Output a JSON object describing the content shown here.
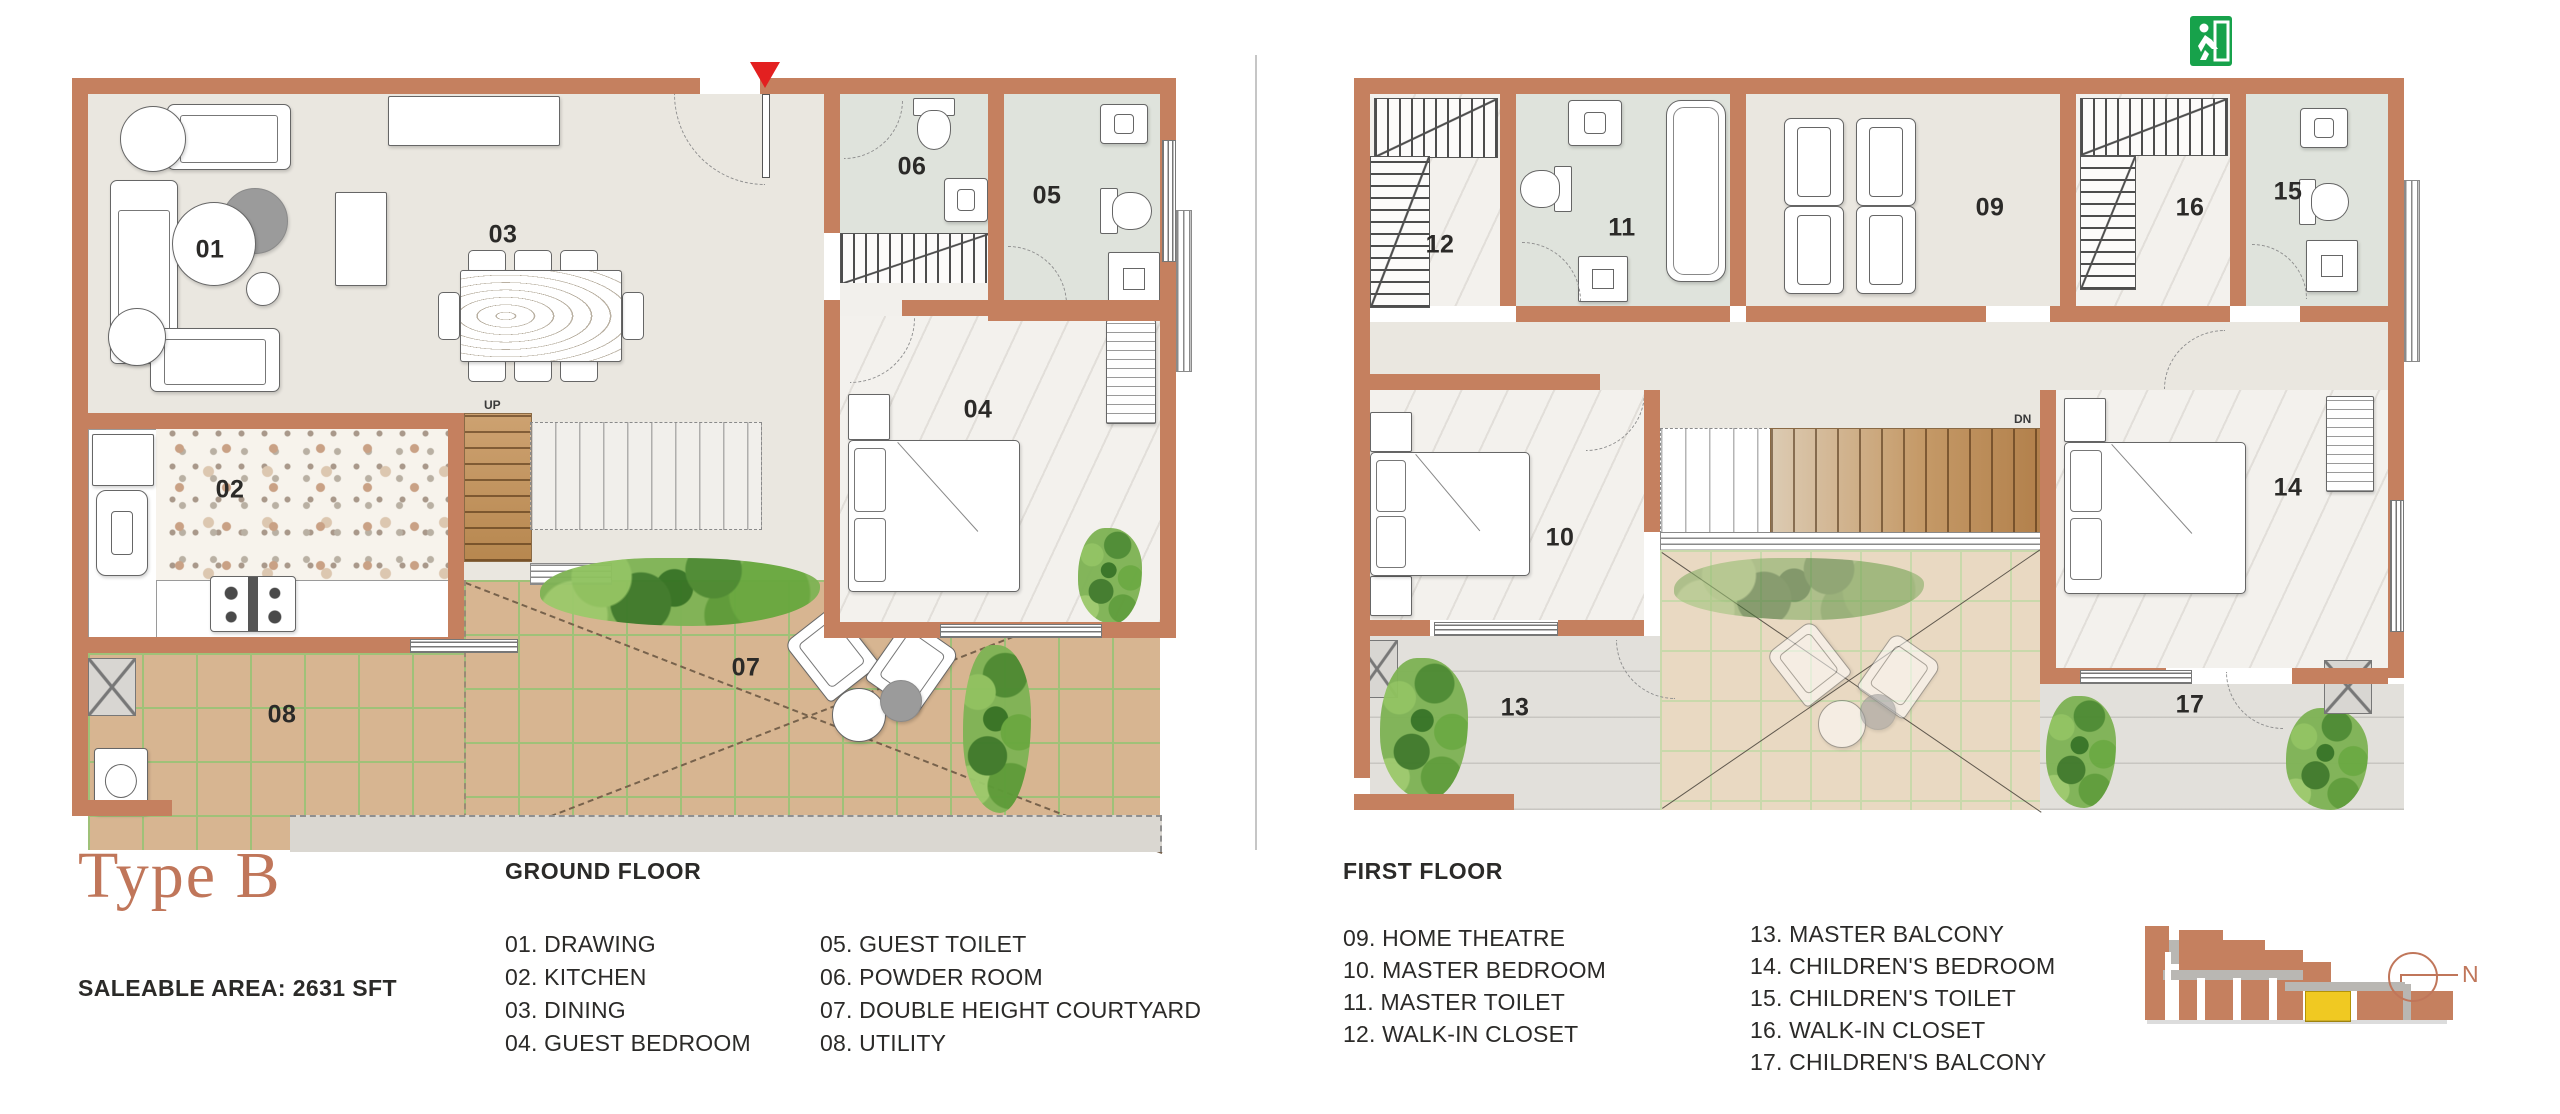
{
  "title": "Type B",
  "saleable_area": "SALEABLE AREA: 2631 SFT",
  "ground_floor": {
    "heading": "GROUND FLOOR",
    "legend_col1": [
      "01. DRAWING",
      "02. KITCHEN",
      "03. DINING",
      "04. GUEST BEDROOM"
    ],
    "legend_col2": [
      "05. GUEST TOILET",
      "06. POWDER ROOM",
      "07. DOUBLE HEIGHT COURTYARD",
      "08. UTILITY"
    ],
    "room_labels": [
      {
        "num": "01",
        "x": 150,
        "y": 190
      },
      {
        "num": "02",
        "x": 170,
        "y": 430
      },
      {
        "num": "03",
        "x": 443,
        "y": 175
      },
      {
        "num": "04",
        "x": 918,
        "y": 350
      },
      {
        "num": "05",
        "x": 987,
        "y": 136
      },
      {
        "num": "06",
        "x": 852,
        "y": 107
      },
      {
        "num": "07",
        "x": 686,
        "y": 608
      },
      {
        "num": "08",
        "x": 222,
        "y": 655
      }
    ],
    "stair_label_up": "UP"
  },
  "first_floor": {
    "heading": "FIRST FLOOR",
    "legend_col1": [
      "09. HOME THEATRE",
      "10. MASTER BEDROOM",
      "11. MASTER TOILET",
      "12. WALK-IN CLOSET"
    ],
    "legend_col2": [
      "13. MASTER BALCONY",
      "14. CHILDREN'S BEDROOM",
      "15. CHILDREN'S TOILET",
      "16. WALK-IN CLOSET",
      "17. CHILDREN'S BALCONY"
    ],
    "room_labels": [
      {
        "num": "09",
        "x": 650,
        "y": 148
      },
      {
        "num": "10",
        "x": 220,
        "y": 478
      },
      {
        "num": "11",
        "x": 282,
        "y": 168
      },
      {
        "num": "12",
        "x": 100,
        "y": 185
      },
      {
        "num": "13",
        "x": 175,
        "y": 648
      },
      {
        "num": "14",
        "x": 948,
        "y": 428
      },
      {
        "num": "15",
        "x": 948,
        "y": 132
      },
      {
        "num": "16",
        "x": 850,
        "y": 148
      },
      {
        "num": "17",
        "x": 850,
        "y": 645
      }
    ],
    "stair_label_dn": "DN"
  },
  "north_label": "N",
  "colors": {
    "wall": "#c5805f",
    "floor": "#eae7e0",
    "floor_marble": "#f3f1ed",
    "floor_toilet": "#dfe3dc",
    "tile_courtyard": "#d7b591",
    "tile_grout": "#9fc178",
    "tile_courtyard_f1": "#e9d9c2",
    "tile_grout_f1": "#c9d9ab",
    "balcony_floor": "#e2e0db",
    "sill": "#dad7d1",
    "marker_red": "#e32020",
    "exit_green": "#17a24b",
    "brand": "#c0765a",
    "text": "#2b2a28",
    "divider": "#c6c6c6",
    "highlight_yellow": "#f0c922",
    "elevation_gray": "#b9b7b3"
  }
}
